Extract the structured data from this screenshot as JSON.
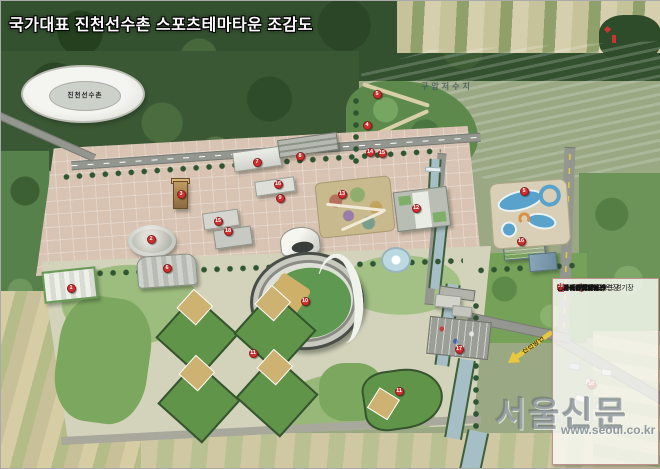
{
  "title": "국가대표 진천선수촌 스포츠테마타운 조감도",
  "labels": {
    "reservoir": "구암저수지",
    "athletes_village": "진천선수촌",
    "road_sign": "진천방면"
  },
  "legend": {
    "title": "범 례",
    "items": [
      {
        "n": "1",
        "label": "BMX 경기장 및 훈련장"
      },
      {
        "n": "2",
        "label": "인라인스케이트·보드 경기장"
      },
      {
        "n": "3",
        "label": "암벽등반"
      },
      {
        "n": "4",
        "label": "짚라인 / 번지점프"
      },
      {
        "n": "5",
        "label": "수상레포츠장"
      },
      {
        "n": "6",
        "label": "에어파크"
      },
      {
        "n": "7",
        "label": "선수촌홍보관"
      },
      {
        "n": "8",
        "label": "스포츠과학교육원"
      },
      {
        "n": "9",
        "label": "스포츠체험센터"
      },
      {
        "n": "10",
        "label": "메인야구장"
      },
      {
        "n": "11",
        "label": "야구장"
      },
      {
        "n": "12",
        "label": "스포츠아울렛몰"
      },
      {
        "n": "13",
        "label": "둘레길 아이어워크"
      },
      {
        "n": "14",
        "label": "청소년야영장"
      },
      {
        "n": "15",
        "label": "산책로 / 전망대"
      },
      {
        "n": "16",
        "label": "스포츠유스호스텔"
      },
      {
        "n": "17",
        "label": "주차장"
      },
      {
        "n": "18",
        "label": "기존마을(62가구)"
      }
    ]
  },
  "markers": [
    {
      "n": "5",
      "x": 376,
      "y": 93
    },
    {
      "n": "4",
      "x": 366,
      "y": 124
    },
    {
      "n": "14",
      "x": 369,
      "y": 151
    },
    {
      "n": "15",
      "x": 381,
      "y": 152
    },
    {
      "n": "8",
      "x": 299,
      "y": 155
    },
    {
      "n": "7",
      "x": 256,
      "y": 161
    },
    {
      "n": "16",
      "x": 277,
      "y": 183
    },
    {
      "n": "9",
      "x": 279,
      "y": 197
    },
    {
      "n": "3",
      "x": 180,
      "y": 193
    },
    {
      "n": "13",
      "x": 341,
      "y": 193
    },
    {
      "n": "12",
      "x": 415,
      "y": 207
    },
    {
      "n": "15",
      "x": 217,
      "y": 220
    },
    {
      "n": "2",
      "x": 150,
      "y": 238
    },
    {
      "n": "18",
      "x": 227,
      "y": 230
    },
    {
      "n": "6",
      "x": 166,
      "y": 267
    },
    {
      "n": "1",
      "x": 70,
      "y": 287
    },
    {
      "n": "10",
      "x": 304,
      "y": 300
    },
    {
      "n": "11",
      "x": 252,
      "y": 352
    },
    {
      "n": "11",
      "x": 398,
      "y": 390
    },
    {
      "n": "5",
      "x": 523,
      "y": 190
    },
    {
      "n": "16",
      "x": 520,
      "y": 240
    },
    {
      "n": "17",
      "x": 458,
      "y": 348
    },
    {
      "n": "18",
      "x": 590,
      "y": 383
    }
  ],
  "watermark": {
    "logo": "서울신문",
    "url": "www.seoul.co.kr"
  },
  "colors": {
    "badge_red": "#cc2a2a",
    "legend_title_red": "#b52222",
    "road_sign_yellow": "#e8c83e",
    "reservoir_blue": "#b3c1c5",
    "forest_green": "#33502f"
  }
}
